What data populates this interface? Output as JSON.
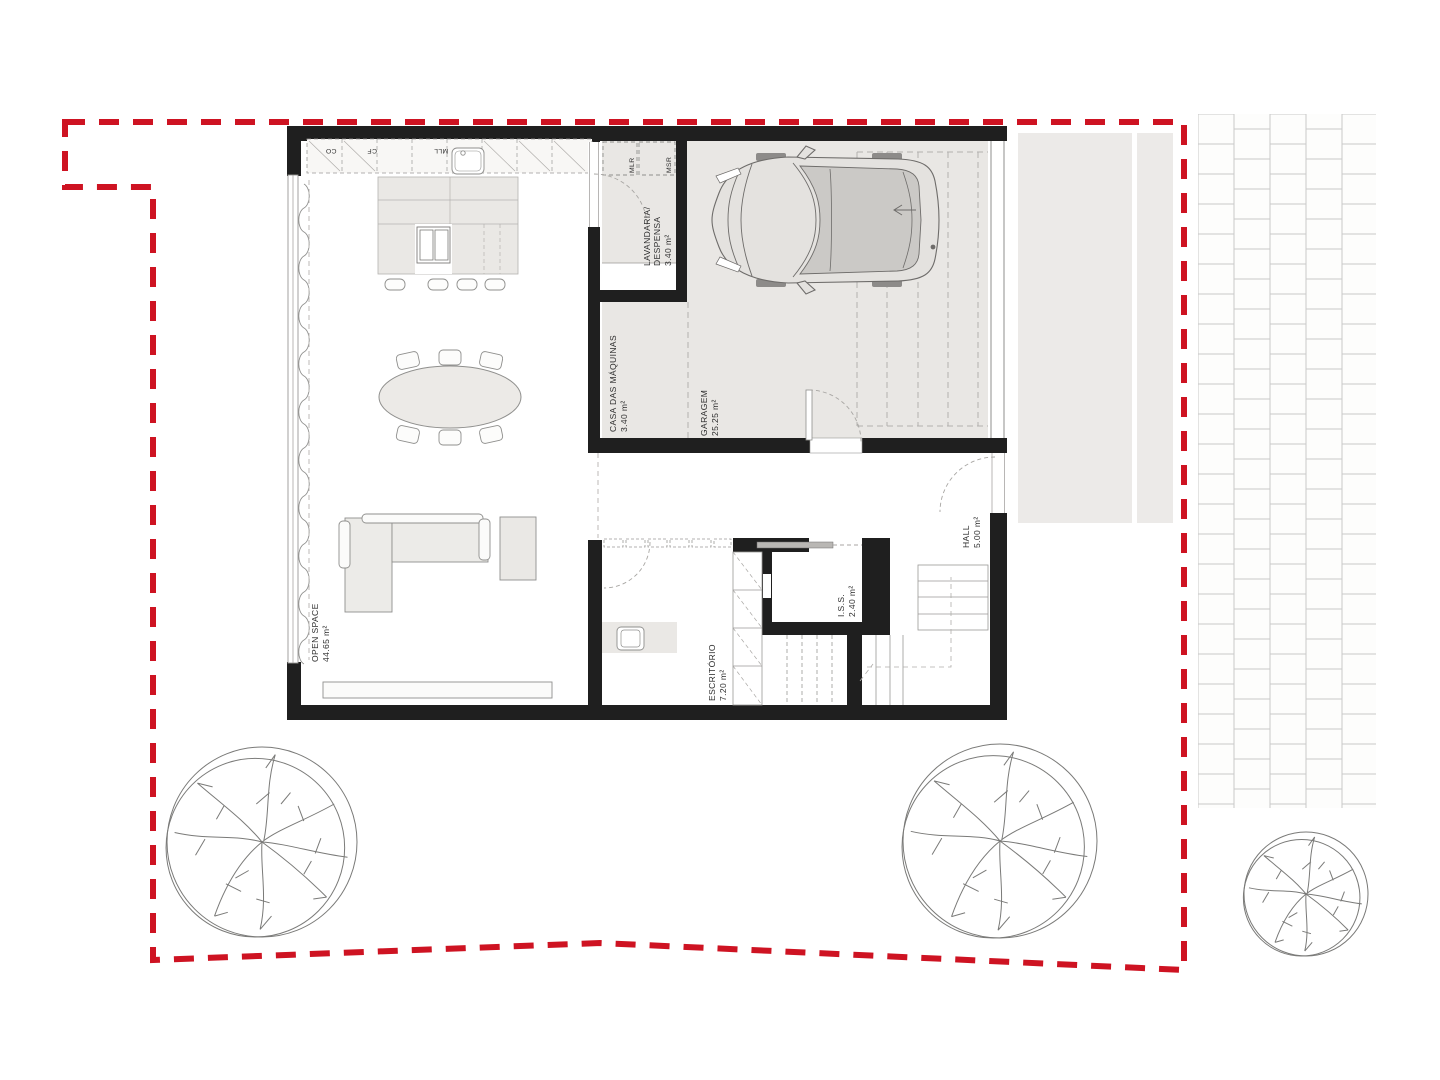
{
  "drawing": {
    "kind": "ground-floor architectural plan with red site boundary"
  },
  "colors": {
    "boundary": "#ce1322",
    "wall": "#1f1f1f",
    "floor": "#e9e7e4",
    "furniture": "#eae8e5",
    "line": "#8f8f8d"
  },
  "rooms": {
    "open_space": {
      "name": "OPEN SPACE",
      "area": "44.65 m²"
    },
    "lavandaria": {
      "line1": "LAVANDARIA/",
      "line2": "DESPENSA",
      "area": "3.40 m²"
    },
    "casa_das_maquinas": {
      "name": "CASA DAS MÁQUINAS",
      "area": "3.40 m²"
    },
    "garagem": {
      "name": "GARAGEM",
      "area": "25.25 m²"
    },
    "hall": {
      "name": "HALL",
      "area": "5.00 m²"
    },
    "iss": {
      "name": "I.S.S.",
      "area": "2.40 m²"
    },
    "escritorio": {
      "name": "ESCRITÓRIO",
      "area": "7.20 m²"
    }
  },
  "kitchen": {
    "cab1": "CO",
    "cab2": "CF",
    "cab3": "MLL"
  },
  "laundry": {
    "washer": "MLR",
    "dryer": "MSR"
  }
}
